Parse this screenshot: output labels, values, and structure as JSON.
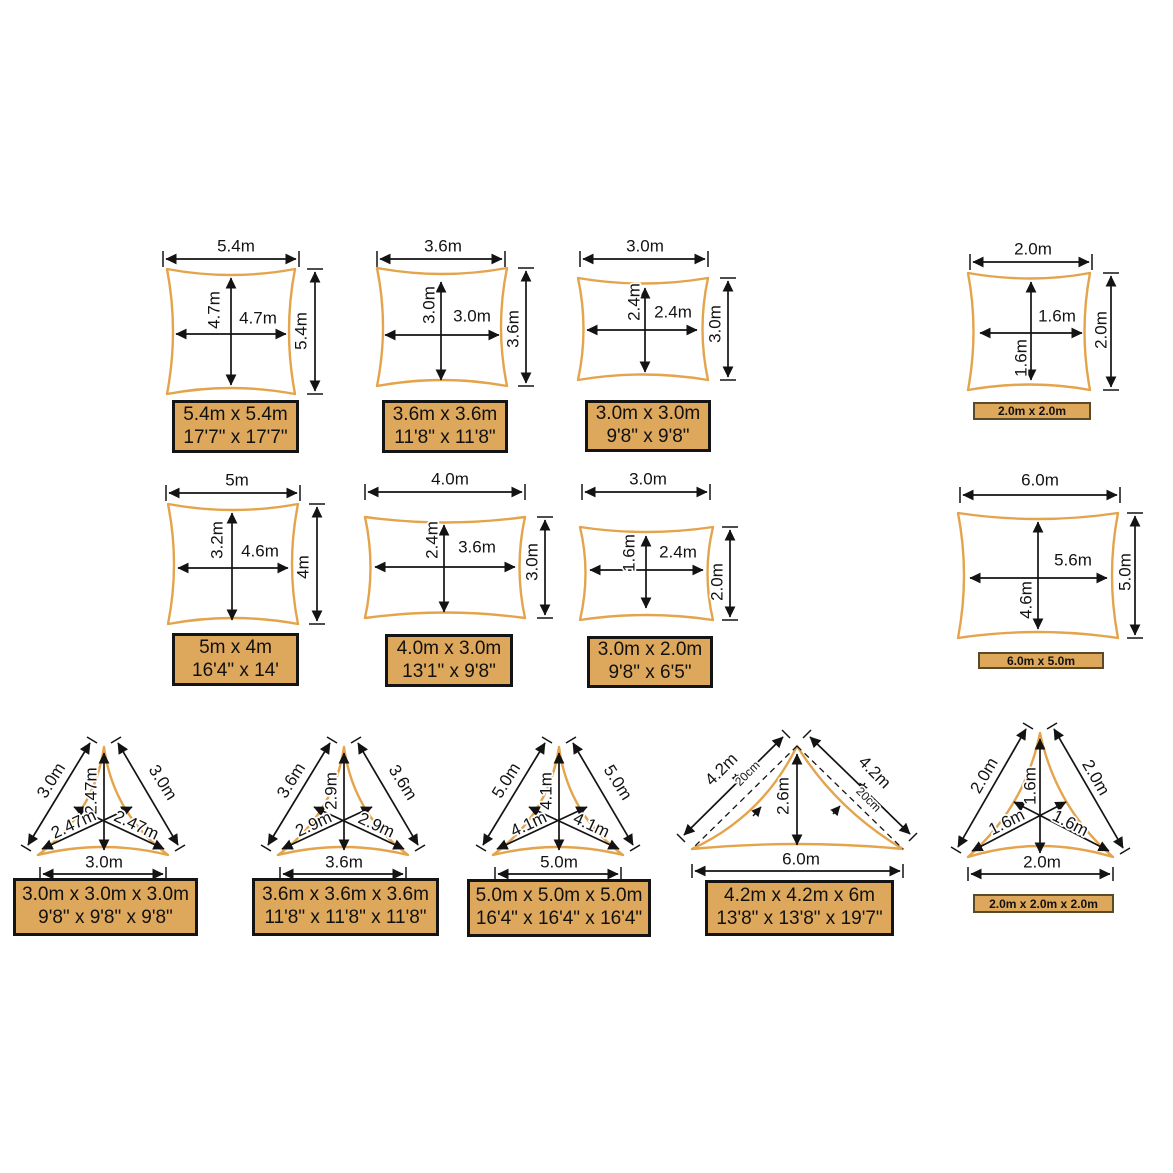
{
  "colors": {
    "sail_outline": "#E3A44C",
    "label_box_fill": "#DDA75C",
    "line": "#131313"
  },
  "squares": [
    {
      "top": "5.4m",
      "side": "5.4m",
      "inner_w": "4.7m",
      "inner_h": "4.7m",
      "metric": "5.4m x 5.4m",
      "imperial": "17'7\" x 17'7\""
    },
    {
      "top": "3.6m",
      "side": "3.6m",
      "inner_w": "3.0m",
      "inner_h": "3.0m",
      "metric": "3.6m x 3.6m",
      "imperial": "11'8\" x 11'8\""
    },
    {
      "top": "3.0m",
      "side": "3.0m",
      "inner_w": "2.4m",
      "inner_h": "2.4m",
      "metric": "3.0m x 3.0m",
      "imperial": "9'8\" x 9'8\""
    },
    {
      "top": "2.0m",
      "side": "2.0m",
      "inner_w": "1.6m",
      "inner_h": "1.6m",
      "metric": "2.0m x 2.0m"
    }
  ],
  "rects": [
    {
      "top": "5m",
      "side": "4m",
      "inner_w": "4.6m",
      "inner_h": "3.2m",
      "metric": "5m x 4m",
      "imperial": "16'4\" x 14'"
    },
    {
      "top": "4.0m",
      "side": "3.0m",
      "inner_w": "3.6m",
      "inner_h": "2.4m",
      "metric": "4.0m x 3.0m",
      "imperial": "13'1\" x 9'8\""
    },
    {
      "top": "3.0m",
      "side": "2.0m",
      "inner_w": "2.4m",
      "inner_h": "1.6m",
      "metric": "3.0m x 2.0m",
      "imperial": "9'8\" x 6'5\""
    },
    {
      "top": "6.0m",
      "side": "5.0m",
      "inner_w": "5.6m",
      "inner_h": "4.6m",
      "metric": "6.0m x 5.0m"
    }
  ],
  "triangles": [
    {
      "left": "3.0m",
      "right": "3.0m",
      "bottom": "3.0m",
      "inner_v": "2.47m",
      "inner_d1": "2.47m",
      "inner_d2": "2.47m",
      "metric": "3.0m x 3.0m x 3.0m",
      "imperial": "9'8\" x 9'8\" x 9'8\""
    },
    {
      "left": "3.6m",
      "right": "3.6m",
      "bottom": "3.6m",
      "inner_v": "2.9m",
      "inner_d1": "2.9m",
      "inner_d2": "2.9m",
      "metric": "3.6m x 3.6m x 3.6m",
      "imperial": "11'8\" x 11'8\" x 11'8\""
    },
    {
      "left": "5.0m",
      "right": "5.0m",
      "bottom": "5.0m",
      "inner_v": "4.1m",
      "inner_d1": "4.1m",
      "inner_d2": "4.1m",
      "metric": "5.0m x 5.0m x 5.0m",
      "imperial": "16'4\" x 16'4\" x 16'4\""
    },
    {
      "left": "4.2m",
      "right": "4.2m",
      "bottom": "6.0m",
      "inner_v": "2.6m",
      "sag_left": "20cm",
      "sag_right": "20cm",
      "metric": "4.2m x 4.2m x 6m",
      "imperial": "13'8\" x 13'8\" x 19'7\""
    },
    {
      "left": "2.0m",
      "right": "2.0m",
      "bottom": "2.0m",
      "inner_v": "1.6m",
      "inner_d1": "1.6m",
      "inner_d2": "1.6m",
      "metric": "2.0m x 2.0m x 2.0m"
    }
  ]
}
